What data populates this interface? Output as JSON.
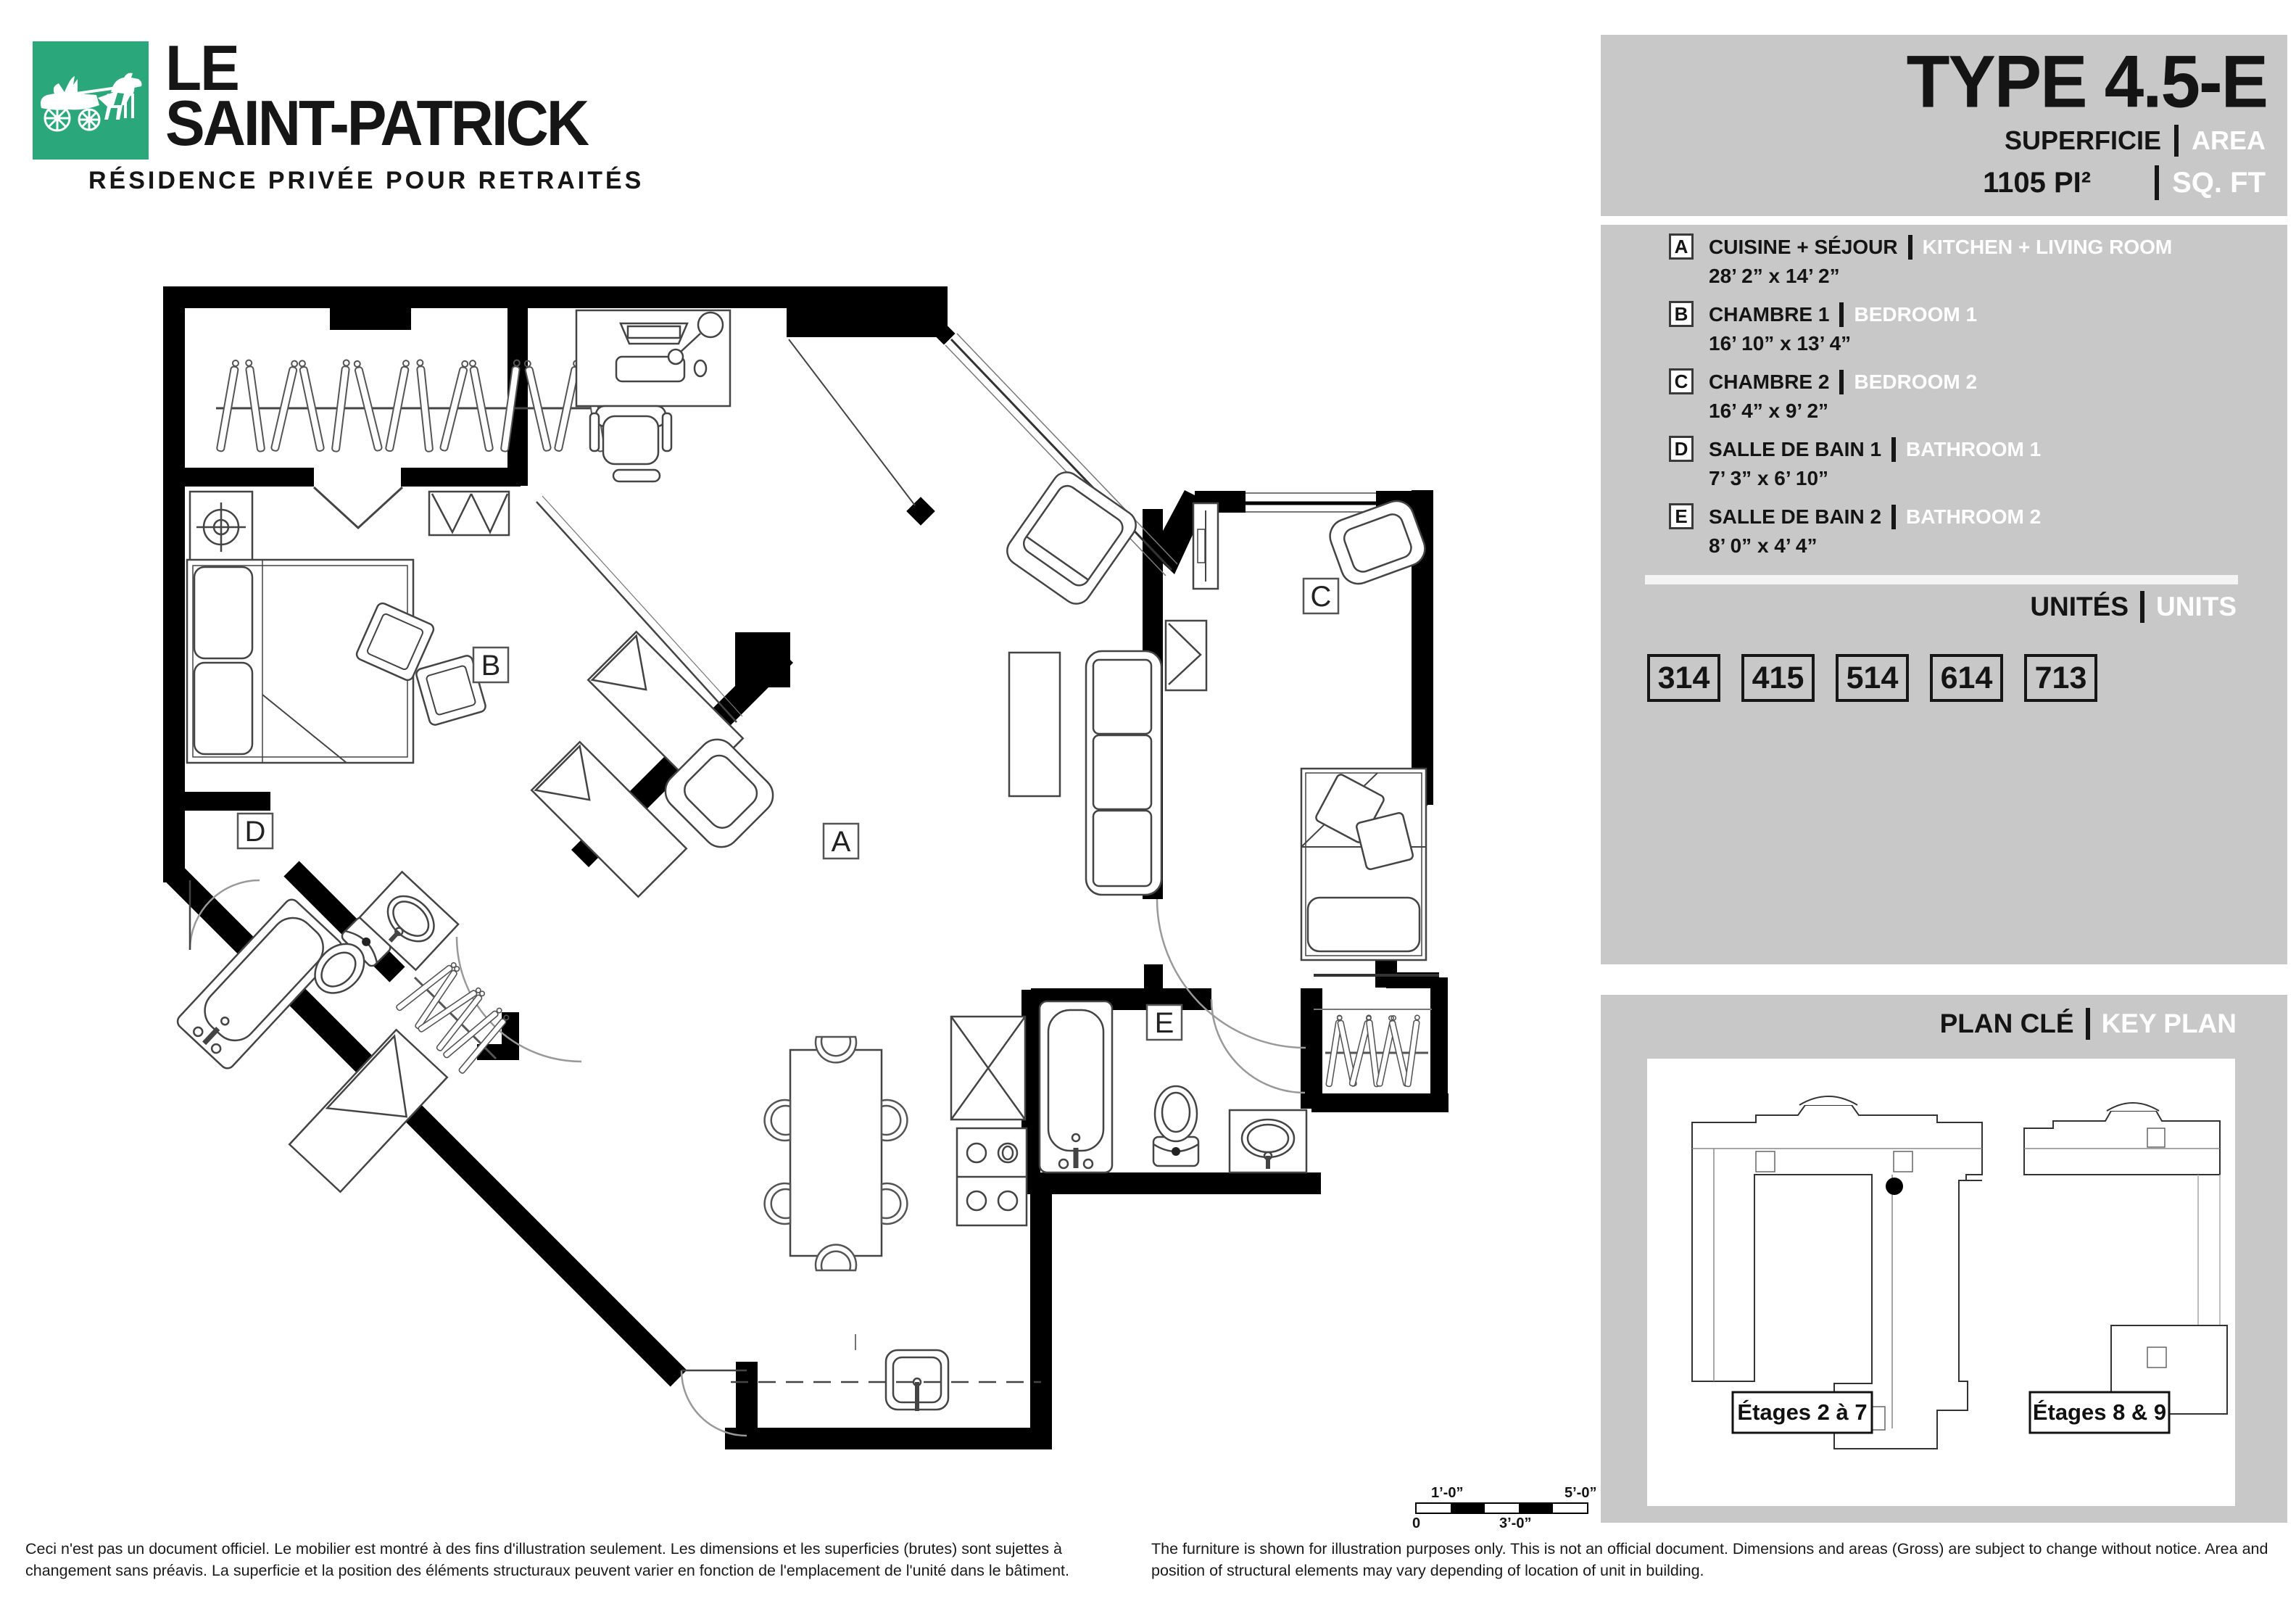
{
  "brand": {
    "le": "LE",
    "name": "SAINT-PATRICK",
    "tagline": "RÉSIDENCE PRIVÉE POUR RETRAITÉS",
    "green": "#2aa87c"
  },
  "title_panel": {
    "title": "TYPE 4.5-E",
    "superficie_label": "SUPERFICIE",
    "area_label": "AREA",
    "area_value": "1105 PI²",
    "sqft_label": "SQ. FT",
    "panel_gray": "#c8c8c8"
  },
  "legend": {
    "items": [
      {
        "letter": "A",
        "fr": "CUISINE + SÉJOUR",
        "en": "KITCHEN + LIVING ROOM",
        "dims": "28’ 2” x 14’ 2”"
      },
      {
        "letter": "B",
        "fr": "CHAMBRE 1",
        "en": "BEDROOM 1",
        "dims": "16’ 10” x 13’ 4”"
      },
      {
        "letter": "C",
        "fr": "CHAMBRE 2",
        "en": "BEDROOM 2",
        "dims": "16’ 4” x 9’ 2”"
      },
      {
        "letter": "D",
        "fr": "SALLE DE BAIN 1",
        "en": "BATHROOM 1",
        "dims": "7’ 3” x 6’ 10”"
      },
      {
        "letter": "E",
        "fr": "SALLE DE BAIN 2",
        "en": "BATHROOM 2",
        "dims": "8’ 0” x 4’ 4”"
      }
    ]
  },
  "units": {
    "label_fr": "UNITÉS",
    "label_en": "UNITS",
    "numbers": [
      "314",
      "415",
      "514",
      "614",
      "713"
    ]
  },
  "key_plan": {
    "label_fr": "PLAN CLÉ",
    "label_en": "KEY PLAN",
    "floors": [
      "Étages 2 à 7",
      "Étages 8 & 9"
    ]
  },
  "plan": {
    "room_labels": [
      "A",
      "B",
      "C",
      "D",
      "E"
    ]
  },
  "scale_bar": {
    "top_left": "1’-0”",
    "top_right": "5’-0”",
    "bottom_left": "0",
    "bottom_center": "3’-0”"
  },
  "disclaimer": {
    "fr": "Ceci n'est pas un document officiel. Le mobilier est montré à des fins d'illustration seulement. Les dimensions et les superficies (brutes) sont sujettes à changement sans préavis. La superficie et la position des éléments structuraux peuvent varier en fonction de l'emplacement de l'unité dans le bâtiment.",
    "en": "The furniture is shown for illustration purposes only. This is not an official document. Dimensions and areas (Gross) are subject to change without notice. Area and position of structural elements may vary depending of location of unit in building."
  }
}
